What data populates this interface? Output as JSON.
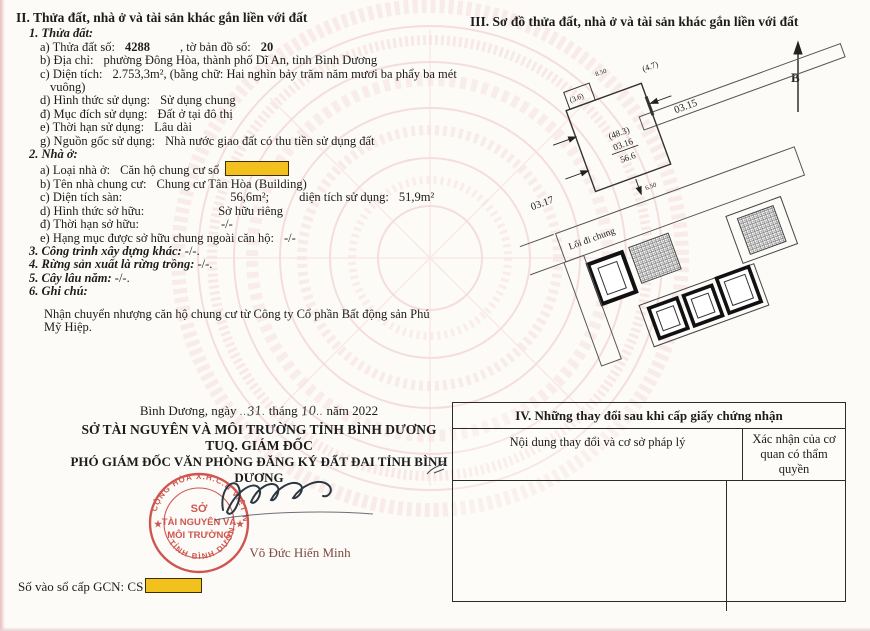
{
  "colors": {
    "accent_yellow": "#f2c11e",
    "stamp_red": "#c8403a",
    "watermark_pink": "#f3d7d7",
    "signer_red": "#7c4a44"
  },
  "section2": {
    "title": "II. Thửa đất, nhà ở và tài sản khác gắn liền với đất",
    "parcel_head": "1. Thửa đất:",
    "parcel": {
      "a_label": "a) Thửa đất số:",
      "a_value": "4288",
      "a_label2": ", tờ bản đồ số:",
      "a_value2": "20",
      "b_label": "b) Địa chỉ:",
      "b_value": "phường Đông Hòa, thành phố Dĩ An, tỉnh Bình Dương",
      "c_label": "c) Diện tích:",
      "c_value": "2.753,3m², (bằng chữ: Hai nghìn bảy trăm năm mươi ba phẩy ba mét",
      "c_value_cont": "vuông)",
      "d_label": "d) Hình thức sử dụng:",
      "d_value": "Sử dụng chung",
      "dd_label": "đ) Mục đích sử dụng:",
      "dd_value": "Đất ở tại đô thị",
      "e_label": "e) Thời hạn sử dụng:",
      "e_value": "Lâu dài",
      "g_label": "g) Nguồn gốc sử dụng:",
      "g_value": "Nhà nước giao đất có thu tiền sử dụng đất"
    },
    "house_head": "2. Nhà ở:",
    "house": {
      "a_label": "a) Loại nhà ở:",
      "a_value": "Căn hộ chung cư số",
      "b_label": "b) Tên nhà chung cư:",
      "b_value": "Chung cư Tân Hòa (Building)",
      "c_label": "c) Diện tích sàn:",
      "c_value": "56,6m²;",
      "c_label2": "diện tích sử dụng:",
      "c_value2": "51,9m²",
      "d_label": "d) Hình thức sở hữu:",
      "d_value": "Sở hữu riêng",
      "dd_label": "đ) Thời hạn sở hữu:",
      "dd_value": "-/-",
      "e_label": "e) Hạng mục được sở hữu chung ngoài căn hộ:",
      "e_value": "-/-"
    },
    "other_head": "3. Công trình xây dựng khác:",
    "other_value": "-/-.",
    "forest_head": "4. Rừng sản xuất là rừng trồng:",
    "forest_value": "-/-.",
    "tree_head": "5. Cây lâu năm:",
    "tree_value": "-/-.",
    "notes_head": "6. Ghi chú:",
    "notes_text": "Nhận chuyển nhượng căn hộ chung cư từ Công ty Cổ phần Bất động sản Phú Mỹ Hiệp."
  },
  "section3": {
    "title": "III. Sơ đồ thửa đất, nhà ở và tài sản khác gắn liền với đất",
    "north_label": "B",
    "dim_top": "8.50",
    "dim_bottom": "6.50",
    "small_box": "(3.6)",
    "neighbor_top": "(4.7)",
    "neighbor_right": "03.15",
    "neighbor_left": "03.17",
    "build_area": "(48.3)",
    "unit_number": "03.16",
    "unit_area": "56.6",
    "walkway_label": "Lối đi chung"
  },
  "section4": {
    "title": "IV. Những thay đổi sau khi cấp giấy chứng nhận",
    "col1": "Nội dung thay đổi và cơ sở pháp lý",
    "col2": "Xác nhận của cơ quan có thẩm quyền"
  },
  "signing": {
    "place_prefix": "Bình Dương, ngày",
    "day": "31",
    "month_word": "tháng",
    "month": "10",
    "year_word": "năm 2022",
    "org": "SỞ TÀI NGUYÊN VÀ MÔI TRƯỜNG TỈNH BÌNH DƯƠNG",
    "title1": "TUQ. GIÁM ĐỐC",
    "title2": "PHÓ GIÁM ĐỐC VĂN PHÒNG ĐĂNG KÝ ĐẤT ĐAI TỈNH BÌNH DƯƠNG",
    "signer_name": "Võ Đức Hiến Minh",
    "gcn_label": "Số vào sổ cấp GCN:",
    "gcn_prefix": "CS"
  },
  "stamp": {
    "arc_top": "CỘNG HÒA X.H.C.N VIỆT NAM",
    "arc_bottom": "TỈNH BÌNH DƯƠNG",
    "line1": "SỞ",
    "line2": "TÀI NGUYÊN VÀ",
    "line3": "MÔI TRƯỜNG"
  }
}
